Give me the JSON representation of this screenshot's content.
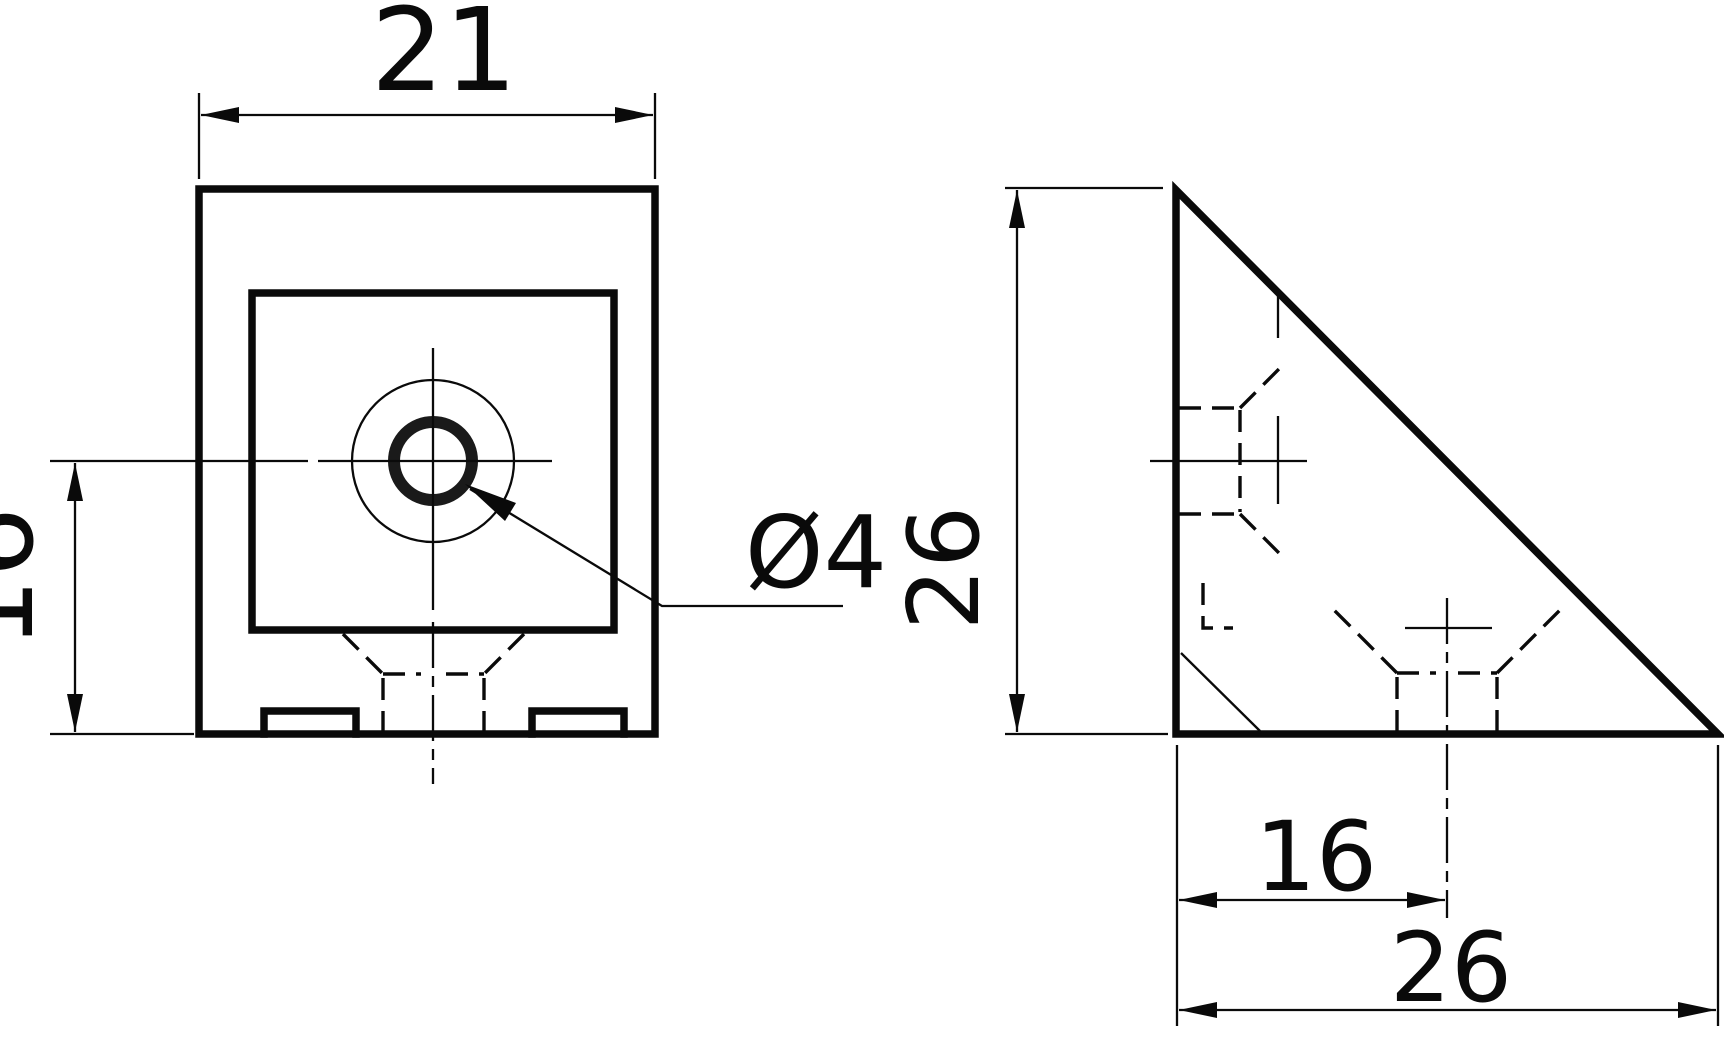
{
  "drawing": {
    "background_color": "#ffffff",
    "line_color": "#0a0a0a",
    "front_view": {
      "name": "front view of corner bracket",
      "width_dim": "21",
      "center_to_bottom_dim": "16",
      "hole_dim": "Ø4"
    },
    "side_view": {
      "name": "side view of corner bracket (right triangle)",
      "height_dim": "26",
      "hole_offset_dim": "16",
      "base_dim": "26"
    }
  }
}
